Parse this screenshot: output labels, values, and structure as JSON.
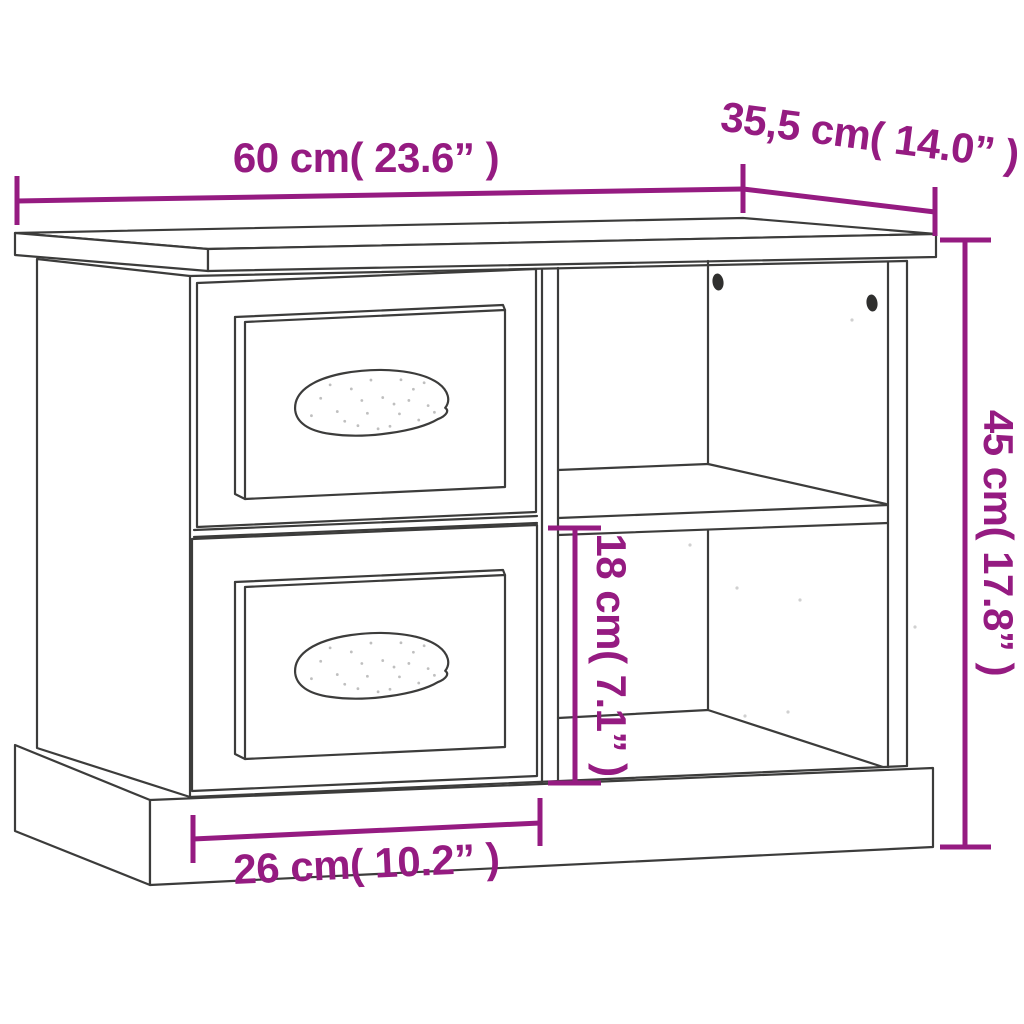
{
  "diagram": {
    "type": "furniture-dimension-diagram",
    "subject": "bedside cabinet with two drawers and open shelf compartment",
    "background_color": "#ffffff",
    "line_color": "#3c3c3b",
    "dimension_color": "#951b81",
    "dimensions": [
      {
        "name": "overall_width",
        "label": "60 cm( 23.6” )",
        "cm": 60,
        "inches": 23.6
      },
      {
        "name": "overall_depth",
        "label": "35,5 cm( 14.0” )",
        "cm": 35.5,
        "inches": 14.0
      },
      {
        "name": "overall_height",
        "label": "45 cm( 17.8” )",
        "cm": 45,
        "inches": 17.8
      },
      {
        "name": "lower_compartment_height",
        "label": "18 cm( 7.1” )",
        "cm": 18,
        "inches": 7.1
      },
      {
        "name": "drawer_front_width",
        "label": "26 cm( 10.2” )",
        "cm": 26,
        "inches": 10.2
      }
    ]
  }
}
